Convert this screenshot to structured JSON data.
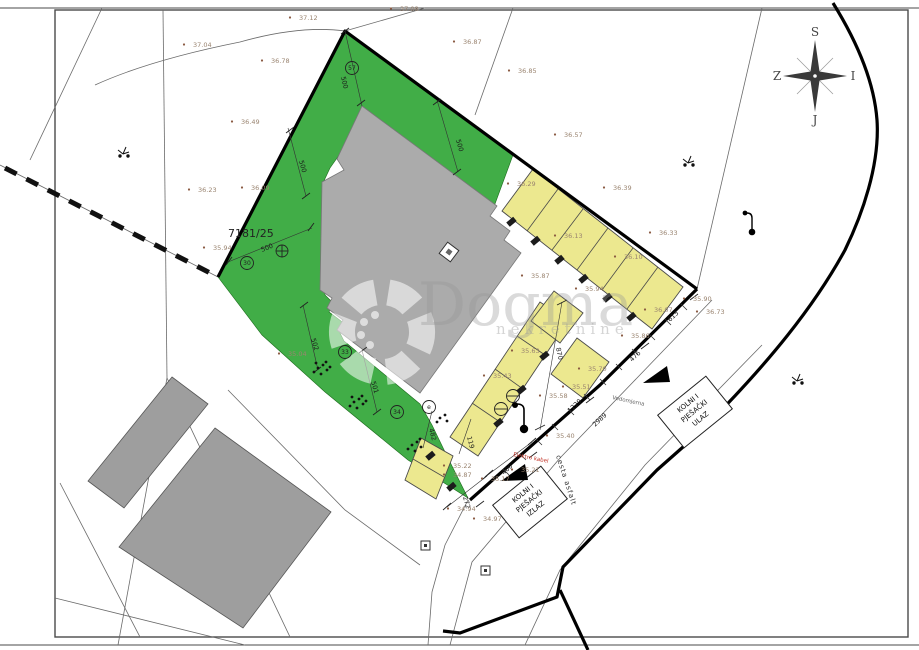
{
  "colors": {
    "parcel_green": "#41ad47",
    "stall_yellow": "#ece88f",
    "building_gray": "#ababab",
    "neighbor_gray": "#9e9e9e",
    "elevation_text": "#9a8470",
    "line_black": "#000000",
    "red_utility": "#c23327"
  },
  "parcel": {
    "number": "7181/25"
  },
  "watermark": {
    "brand": "Dogma",
    "subtitle": "nekretnine"
  },
  "compass": {
    "north": "S",
    "east": "I",
    "south": "J",
    "west": "Z"
  },
  "roads": {
    "surface": "cesta asfalt",
    "utility": "Vodomjerna",
    "power": "Elektro kabel"
  },
  "entrances": {
    "entry_lines": [
      "KOLNI I",
      "PJEŠAČKI",
      "ULAZ"
    ],
    "exit_lines": [
      "KOLNI I",
      "PJEŠAČKI",
      "IZLAZ"
    ]
  },
  "dimensions": [
    {
      "text": "500",
      "x": 341,
      "y": 77,
      "rot": 77
    },
    {
      "text": "500",
      "x": 456,
      "y": 140,
      "rot": 74
    },
    {
      "text": "500",
      "x": 299,
      "y": 161,
      "rot": 74
    },
    {
      "text": "500",
      "x": 262,
      "y": 252,
      "rot": -22
    },
    {
      "text": "502",
      "x": 311,
      "y": 339,
      "rot": 73
    },
    {
      "text": "501",
      "x": 371,
      "y": 382,
      "rot": 73
    },
    {
      "text": "613",
      "x": 670,
      "y": 322,
      "rot": -43
    },
    {
      "text": "476",
      "x": 632,
      "y": 362,
      "rot": -43
    },
    {
      "text": "870",
      "x": 556,
      "y": 348,
      "rot": 78
    },
    {
      "text": "1229",
      "x": 570,
      "y": 413,
      "rot": -43
    },
    {
      "text": "2989",
      "x": 595,
      "y": 427,
      "rot": -43
    },
    {
      "text": "400",
      "x": 504,
      "y": 475,
      "rot": -43
    },
    {
      "text": "272",
      "x": 463,
      "y": 497,
      "rot": 75
    },
    {
      "text": "119",
      "x": 467,
      "y": 437,
      "rot": 75
    },
    {
      "text": "482",
      "x": 429,
      "y": 429,
      "rot": 75
    }
  ],
  "elevations": [
    {
      "text": "37.12",
      "x": 299,
      "y": 20
    },
    {
      "text": "37.08",
      "x": 400,
      "y": 11
    },
    {
      "text": "37.04",
      "x": 193,
      "y": 47
    },
    {
      "text": "36.78",
      "x": 271,
      "y": 63
    },
    {
      "text": "36.49",
      "x": 241,
      "y": 124
    },
    {
      "text": "36.87",
      "x": 463,
      "y": 44
    },
    {
      "text": "36.85",
      "x": 518,
      "y": 73
    },
    {
      "text": "36.57",
      "x": 564,
      "y": 137
    },
    {
      "text": "36.23",
      "x": 198,
      "y": 192
    },
    {
      "text": "36.09",
      "x": 251,
      "y": 190
    },
    {
      "text": "35.94",
      "x": 213,
      "y": 250
    },
    {
      "text": "36.29",
      "x": 517,
      "y": 186
    },
    {
      "text": "36.39",
      "x": 613,
      "y": 190
    },
    {
      "text": "36.33",
      "x": 659,
      "y": 235
    },
    {
      "text": "36.13",
      "x": 564,
      "y": 238
    },
    {
      "text": "36.10",
      "x": 624,
      "y": 259
    },
    {
      "text": "35.87",
      "x": 531,
      "y": 278
    },
    {
      "text": "35.94",
      "x": 585,
      "y": 291
    },
    {
      "text": "36.07",
      "x": 654,
      "y": 312
    },
    {
      "text": "35.90",
      "x": 693,
      "y": 301
    },
    {
      "text": "36.73",
      "x": 706,
      "y": 314
    },
    {
      "text": "35.86",
      "x": 631,
      "y": 338
    },
    {
      "text": "35.63",
      "x": 521,
      "y": 353
    },
    {
      "text": "35.43",
      "x": 493,
      "y": 378
    },
    {
      "text": "35.70",
      "x": 588,
      "y": 371
    },
    {
      "text": "35.51",
      "x": 572,
      "y": 389
    },
    {
      "text": "35.58",
      "x": 549,
      "y": 398
    },
    {
      "text": "35.04",
      "x": 288,
      "y": 356
    },
    {
      "text": "35.40",
      "x": 556,
      "y": 438
    },
    {
      "text": "35.22",
      "x": 453,
      "y": 468
    },
    {
      "text": "34.87",
      "x": 453,
      "y": 477
    },
    {
      "text": "35.21",
      "x": 521,
      "y": 472
    },
    {
      "text": "35.17",
      "x": 491,
      "y": 481
    },
    {
      "text": "34.94",
      "x": 457,
      "y": 511
    },
    {
      "text": "34.97",
      "x": 483,
      "y": 521
    }
  ],
  "markers": [
    {
      "label": "57",
      "x": 352,
      "y": 68
    },
    {
      "label": "30",
      "x": 247,
      "y": 263
    },
    {
      "label": "33",
      "x": 345,
      "y": 352
    },
    {
      "label": "34",
      "x": 397,
      "y": 412
    },
    {
      "label": "e",
      "x": 429,
      "y": 407
    }
  ]
}
